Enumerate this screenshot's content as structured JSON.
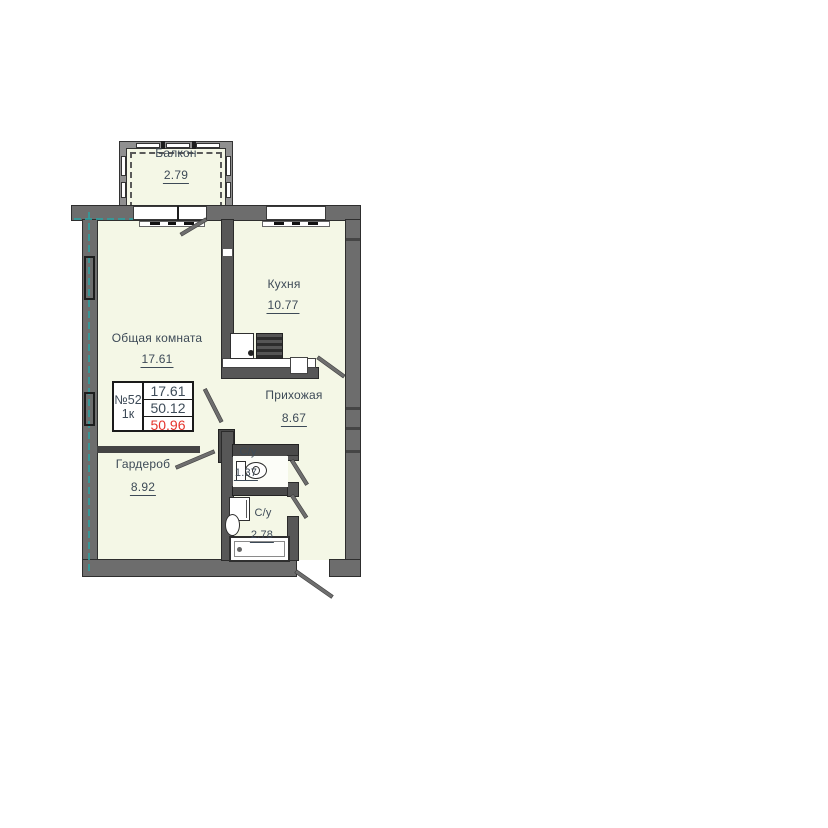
{
  "unit": {
    "number": "№52",
    "type": "1к",
    "values": {
      "living": "17.61",
      "middle": "50.12",
      "total": "50.96"
    }
  },
  "rooms": {
    "balcony": {
      "label": "Балкон",
      "area": "2.79"
    },
    "living": {
      "label": "Общая комната",
      "area": "17.61"
    },
    "kitchen": {
      "label": "Кухня",
      "area": "10.77"
    },
    "hallway": {
      "label": "Прихожая",
      "area": "8.67"
    },
    "wardrobe": {
      "label": "Гардероб",
      "area": "8.92"
    },
    "wc_small": {
      "label": "С/у",
      "area": "1.37"
    },
    "wc_large": {
      "label": "С/у",
      "area": "2.78"
    }
  },
  "colors": {
    "room_fill": "#f4f7e6",
    "wall_gray": "#6d6d6d",
    "wall_dark": "#4a4a4a",
    "outline": "#2e2e2e",
    "text": "#3d4a57",
    "highlight_red": "#e5342c",
    "axis_teal": "#2f9e9e"
  }
}
